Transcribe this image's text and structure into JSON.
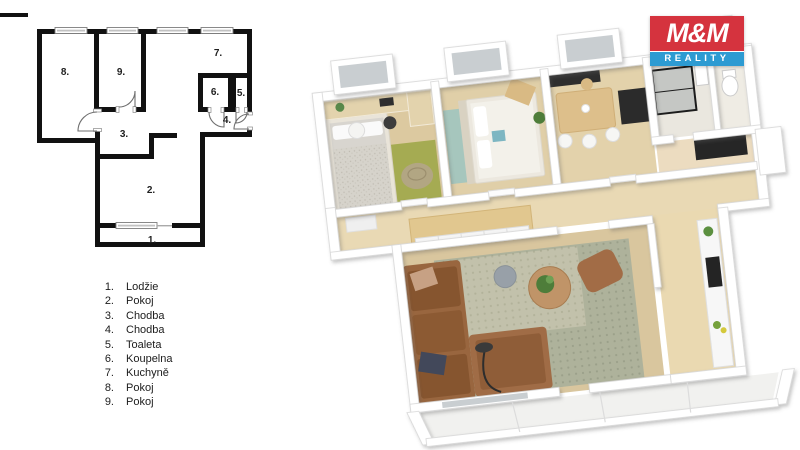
{
  "logo": {
    "title": "M&M",
    "subtitle": "REALITY",
    "color_red": "#d5333e",
    "color_blue": "#2d9bd2",
    "color_text": "#ffffff"
  },
  "plan2d": {
    "wall_color": "#111111",
    "labels": {
      "r1": "1.",
      "r2": "2.",
      "r3": "3.",
      "r4": "4.",
      "r5": "5.",
      "r6": "6.",
      "r7": "7.",
      "r8": "8.",
      "r9": "9."
    }
  },
  "legend": {
    "items": [
      {
        "num": "1.",
        "label": "Lodžie"
      },
      {
        "num": "2.",
        "label": "Pokoj"
      },
      {
        "num": "3.",
        "label": "Chodba"
      },
      {
        "num": "4.",
        "label": "Chodba"
      },
      {
        "num": "5.",
        "label": "Toaleta"
      },
      {
        "num": "6.",
        "label": "Koupelna"
      },
      {
        "num": "7.",
        "label": "Kuchyně"
      },
      {
        "num": "8.",
        "label": "Pokoj"
      },
      {
        "num": "9.",
        "label": "Pokoj"
      }
    ]
  },
  "plan3d": {
    "colors": {
      "floor_wood": "#dcc9a0",
      "floor_corridor": "#e9d9b4",
      "rug_green": "#a5ab52",
      "rug_teal": "#a6c6bd",
      "rug_living": "#aeb29b",
      "sofa_brown": "#99663f",
      "furniture_wood": "#e1c78f",
      "appliance_black": "#2b2b2b",
      "glass": "#c9ced1",
      "wall_white": "#ffffff",
      "plant_green": "#4e7d3a"
    }
  }
}
